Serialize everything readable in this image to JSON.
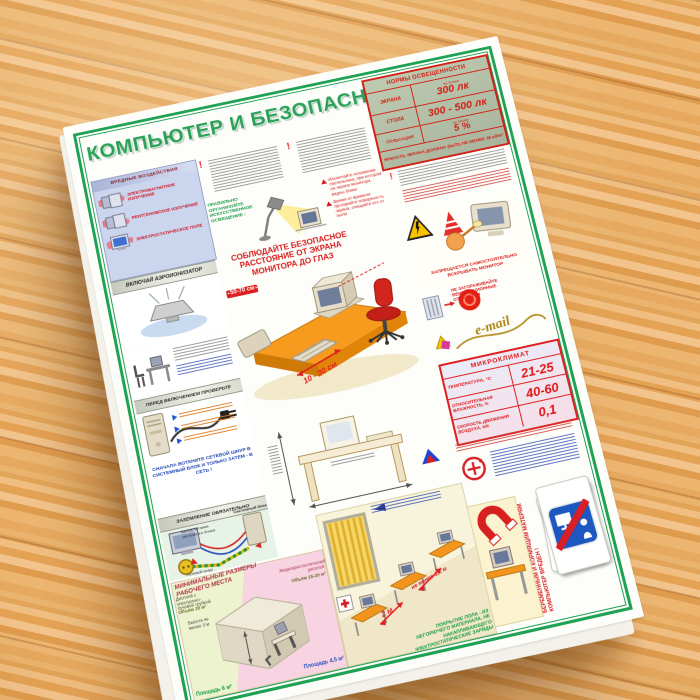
{
  "poster": {
    "title": "КОМПЬЮТЕР И БЕЗОПАСНОСТЬ",
    "norms": {
      "title": "НОРМЫ ОСВЕЩЕННОСТИ",
      "rows": [
        {
          "label": "ЭКРАНА",
          "prefix": "не более",
          "value": "300 лк"
        },
        {
          "label": "СТОЛА",
          "prefix": "",
          "value": "300 - 500 лк"
        },
        {
          "label": "ПУЛЬСАЦИЯ",
          "prefix": "не более",
          "value": "5 %"
        }
      ],
      "footer": "ЯРКОСТЬ ЭКРАНА ДОЛЖНА БЫТЬ НЕ МЕНЕЕ 35 кд/м²"
    },
    "left": {
      "harmful": {
        "title": "ВРЕДНЫЕ ВОЗДЕЙСТВИЯ",
        "items": [
          "ЭЛЕКТРОМАГНИТНОЕ ИЗЛУЧЕНИЕ",
          "РЕНТГЕНОВСКОЕ ИЗЛУЧЕНИЕ",
          "ЭЛЕКТРОСТАТИЧЕСКОЕ ПОЛЕ"
        ]
      },
      "ionizer": {
        "title": "ВКЛЮЧАЙ АЭРОИОНИЗАТОР"
      },
      "check": {
        "title": "ПЕРЕД ВКЛЮЧЕНИЕМ ПРОВЕРЬТЕ",
        "note": "СНАЧАЛА ВОТКНИТЕ СЕТЕВОЙ ШНУР В СИСТЕМНЫЙ БЛОК И ТОЛЬКО ЗАТЕМ - В СЕТЬ !"
      },
      "grounding": {
        "title": "ЗАЗЕМЛЕНИЕ ОБЯЗАТЕЛЬНО",
        "labels": [
          "Системный блок",
          "Сетевой шнур",
          "Вилка питания системного блока"
        ]
      }
    },
    "center": {
      "lighting": {
        "title": "ПРАВИЛЬНО ОРГАНИЗУЙТЕ ИСКУССТВЕННОЕ ОСВЕЩЕНИЕ :",
        "tips": [
          "Исключайте положение светильника, при котором на экране монитора видны блики",
          "Время от времени протирайте поверхность экрана, очищайте его от пыли"
        ]
      },
      "distance": {
        "title": "СОБЛЮДАЙТЕ БЕЗОПАСНОЕ РАССТОЯНИЕ ОТ ЭКРАНА МОНИТОРА ДО ГЛАЗ",
        "screen_eyes": "50-70 см",
        "keyboard_edge": "10 - 30 см"
      }
    },
    "right": {
      "no_open": "ЗАПРЕЩАЕТСЯ САМОСТОЯТЕЛЬНО ВСКРЫВАТЬ МОНИТОР",
      "vents": "НЕ ЗАГОРАЖИВАЙТЕ ВЕНТИЛЯЦИОННЫЕ ОТВЕРСТИЯ",
      "email": "e-mail",
      "microclimate": {
        "title": "МИКРОКЛИМАТ",
        "rows": [
          {
            "label": "ТЕМПЕРАТУРА, °C",
            "value": "21-25"
          },
          {
            "label": "ОТНОСИТЕЛЬНАЯ ВЛАЖНОСТЬ, %",
            "value": "40-60"
          },
          {
            "label": "СКОРОСТЬ ДВИЖЕНИЯ ВОЗДУХА, м/с",
            "value": "0,1"
          }
        ]
      },
      "pregnancy": "БЕРЕМЕННЫМ И КОРМЯЩИМ МАТЕРЯМ КОМПЬЮТЕР ВРЕДЕН !"
    },
    "bottom": {
      "workspace": {
        "title": "МИНИМАЛЬНЫЕ РАЗМЕРЫ РАБОЧЕГО МЕСТА",
        "crt": "Дисплей с электронно-лучевой трубкой",
        "lcd": "Жидкокристаллический дисплей",
        "volume_crt": "Объём 20 м³",
        "volume_lcd": "Объём 15-20 м³",
        "height": "Высота не менее 3 м",
        "area_crt": "Площадь 6 м²",
        "area_lcd": "Площадь 4,5 м²"
      },
      "room": {
        "row_distance": "2 м",
        "screen_distance": "не менее 1,2 м",
        "floor": "ПОКРЫТИЕ ПОЛА - ИЗ НЕГОРЮЧЕГО МАТЕРИАЛА, НЕ НАКАПЛИВАЮЩЕГО ЭЛЕКТРОСТАТИЧЕСКИЕ ЗАРЯДЫ"
      }
    }
  }
}
